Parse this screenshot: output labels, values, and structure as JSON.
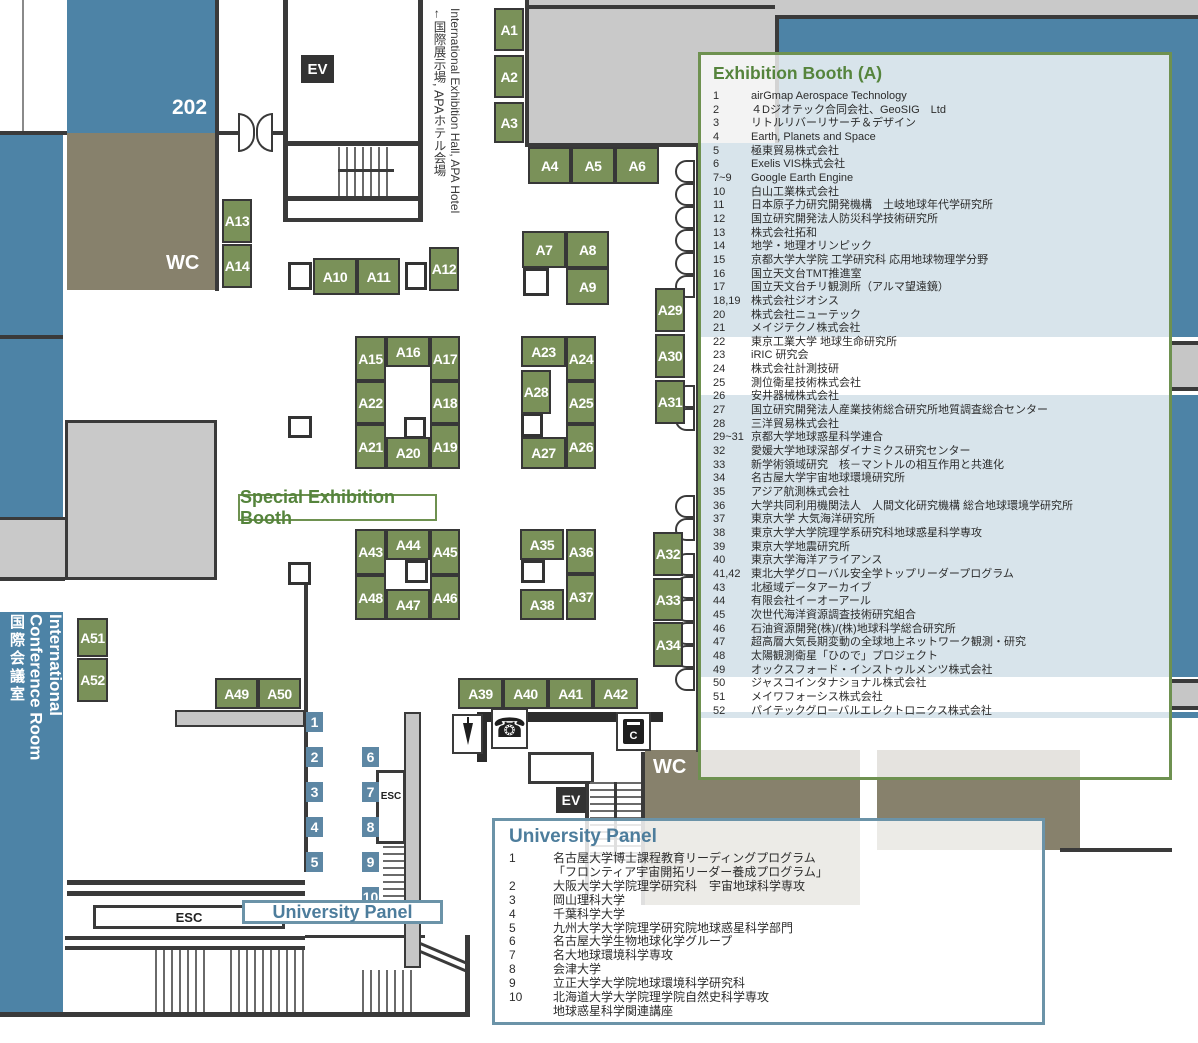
{
  "colors": {
    "map_blue": "#4d83a6",
    "num_blue": "#5d87a4",
    "olive": "#87816c",
    "hall_gray": "#c9c9c9",
    "booth_green": "#7a9159",
    "panel_green": "#6e9150",
    "panel_green_text": "#55843c",
    "uni_blue_border": "#6b93a8",
    "uni_blue_text": "#4d7d9c"
  },
  "map": {
    "rooms": {
      "room202": "202",
      "wc_top": "WC",
      "wc_bottom": "WC",
      "ev_top": "EV",
      "ev_bottom": "EV",
      "esc_mid": "ESC",
      "esc_bottom": "ESC"
    },
    "labels": {
      "special_booth": "Special Exhibition Booth",
      "university_tag": "University Panel",
      "conference_en": "International Conference Room",
      "conference_jp": "国際会議室",
      "exit_en": "International Exhibition Hall, APA Hotel",
      "exit_jp": "←国際展示場, APAホテル会場"
    },
    "icons": {
      "phone_glyph": "☎",
      "copier_label": "C"
    },
    "panel_numbers": {
      "col1": [
        "1",
        "2",
        "3",
        "4",
        "5"
      ],
      "col2": [
        "6",
        "7",
        "8",
        "9",
        "10"
      ]
    },
    "door_pairs_right": [
      160,
      206,
      252,
      385,
      495,
      553,
      599,
      645
    ],
    "squares": [
      [
        288,
        262,
        24,
        28
      ],
      [
        405,
        262,
        22,
        28
      ],
      [
        523,
        268,
        26,
        28
      ],
      [
        288,
        416,
        24,
        22
      ],
      [
        404,
        417,
        22,
        22
      ],
      [
        521,
        413,
        22,
        24
      ],
      [
        288,
        562,
        23,
        23
      ],
      [
        405,
        560,
        23,
        23
      ],
      [
        521,
        560,
        24,
        23
      ]
    ],
    "booths": [
      {
        "label": "A1",
        "x": 494,
        "y": 8,
        "w": 30,
        "h": 43
      },
      {
        "label": "A2",
        "x": 494,
        "y": 55,
        "w": 30,
        "h": 43
      },
      {
        "label": "A3",
        "x": 494,
        "y": 102,
        "w": 30,
        "h": 41
      },
      {
        "label": "A4",
        "x": 528,
        "y": 147,
        "w": 43,
        "h": 37
      },
      {
        "label": "A5",
        "x": 571,
        "y": 147,
        "w": 44,
        "h": 37
      },
      {
        "label": "A6",
        "x": 615,
        "y": 147,
        "w": 44,
        "h": 37
      },
      {
        "label": "A7",
        "x": 522,
        "y": 231,
        "w": 44,
        "h": 37
      },
      {
        "label": "A8",
        "x": 566,
        "y": 231,
        "w": 43,
        "h": 37
      },
      {
        "label": "A9",
        "x": 566,
        "y": 268,
        "w": 43,
        "h": 37
      },
      {
        "label": "A10",
        "x": 313,
        "y": 258,
        "w": 44,
        "h": 37
      },
      {
        "label": "A11",
        "x": 357,
        "y": 258,
        "w": 43,
        "h": 37
      },
      {
        "label": "A12",
        "x": 429,
        "y": 247,
        "w": 30,
        "h": 44
      },
      {
        "label": "A13",
        "x": 222,
        "y": 199,
        "w": 30,
        "h": 44
      },
      {
        "label": "A14",
        "x": 222,
        "y": 244,
        "w": 30,
        "h": 44
      },
      {
        "label": "A15",
        "x": 355,
        "y": 336,
        "w": 31,
        "h": 45
      },
      {
        "label": "A16",
        "x": 386,
        "y": 336,
        "w": 44,
        "h": 31
      },
      {
        "label": "A17",
        "x": 430,
        "y": 336,
        "w": 30,
        "h": 45
      },
      {
        "label": "A18",
        "x": 430,
        "y": 381,
        "w": 30,
        "h": 43
      },
      {
        "label": "A19",
        "x": 430,
        "y": 424,
        "w": 30,
        "h": 45
      },
      {
        "label": "A20",
        "x": 386,
        "y": 437,
        "w": 44,
        "h": 32
      },
      {
        "label": "A21",
        "x": 355,
        "y": 424,
        "w": 31,
        "h": 45
      },
      {
        "label": "A22",
        "x": 355,
        "y": 381,
        "w": 31,
        "h": 43
      },
      {
        "label": "A23",
        "x": 521,
        "y": 336,
        "w": 45,
        "h": 31
      },
      {
        "label": "A24",
        "x": 566,
        "y": 336,
        "w": 30,
        "h": 45
      },
      {
        "label": "A25",
        "x": 566,
        "y": 381,
        "w": 30,
        "h": 43
      },
      {
        "label": "A26",
        "x": 566,
        "y": 424,
        "w": 30,
        "h": 45
      },
      {
        "label": "A27",
        "x": 521,
        "y": 437,
        "w": 45,
        "h": 32
      },
      {
        "label": "A28",
        "x": 521,
        "y": 370,
        "w": 30,
        "h": 44
      },
      {
        "label": "A29",
        "x": 655,
        "y": 288,
        "w": 30,
        "h": 44
      },
      {
        "label": "A30",
        "x": 655,
        "y": 334,
        "w": 30,
        "h": 44
      },
      {
        "label": "A31",
        "x": 655,
        "y": 380,
        "w": 30,
        "h": 44
      },
      {
        "label": "A32",
        "x": 653,
        "y": 532,
        "w": 30,
        "h": 44
      },
      {
        "label": "A33",
        "x": 653,
        "y": 578,
        "w": 30,
        "h": 43
      },
      {
        "label": "A34",
        "x": 653,
        "y": 622,
        "w": 30,
        "h": 45
      },
      {
        "label": "A35",
        "x": 520,
        "y": 529,
        "w": 44,
        "h": 31
      },
      {
        "label": "A36",
        "x": 566,
        "y": 529,
        "w": 30,
        "h": 45
      },
      {
        "label": "A37",
        "x": 566,
        "y": 574,
        "w": 30,
        "h": 46
      },
      {
        "label": "A38",
        "x": 520,
        "y": 589,
        "w": 44,
        "h": 31
      },
      {
        "label": "A39",
        "x": 458,
        "y": 678,
        "w": 45,
        "h": 31
      },
      {
        "label": "A40",
        "x": 503,
        "y": 678,
        "w": 45,
        "h": 31
      },
      {
        "label": "A41",
        "x": 548,
        "y": 678,
        "w": 45,
        "h": 31
      },
      {
        "label": "A42",
        "x": 593,
        "y": 678,
        "w": 45,
        "h": 31
      },
      {
        "label": "A43",
        "x": 355,
        "y": 529,
        "w": 31,
        "h": 46
      },
      {
        "label": "A44",
        "x": 386,
        "y": 529,
        "w": 44,
        "h": 31
      },
      {
        "label": "A45",
        "x": 430,
        "y": 529,
        "w": 30,
        "h": 46
      },
      {
        "label": "A46",
        "x": 430,
        "y": 575,
        "w": 30,
        "h": 45
      },
      {
        "label": "A47",
        "x": 386,
        "y": 589,
        "w": 44,
        "h": 31
      },
      {
        "label": "A48",
        "x": 355,
        "y": 575,
        "w": 31,
        "h": 45
      },
      {
        "label": "A49",
        "x": 215,
        "y": 678,
        "w": 43,
        "h": 31
      },
      {
        "label": "A50",
        "x": 258,
        "y": 678,
        "w": 43,
        "h": 31
      },
      {
        "label": "A51",
        "x": 77,
        "y": 618,
        "w": 31,
        "h": 39
      },
      {
        "label": "A52",
        "x": 77,
        "y": 658,
        "w": 31,
        "h": 44
      }
    ]
  },
  "exhibition_panel": {
    "title": "Exhibition Booth (A)",
    "entries": [
      {
        "no": "1",
        "name": "airGmap Aerospace Technology"
      },
      {
        "no": "2",
        "name": "４Dジオテック合同会社、GeoSIG　Ltd"
      },
      {
        "no": "3",
        "name": "リトルリバーリサーチ＆デザイン"
      },
      {
        "no": "4",
        "name": "Earth, Planets and Space"
      },
      {
        "no": "5",
        "name": "極東貿易株式会社"
      },
      {
        "no": "6",
        "name": "Exelis VIS株式会社"
      },
      {
        "no": "7~9",
        "name": "Google Earth Engine"
      },
      {
        "no": "10",
        "name": "白山工業株式会社"
      },
      {
        "no": "11",
        "name": "日本原子力研究開発機構　土岐地球年代学研究所"
      },
      {
        "no": "12",
        "name": "国立研究開発法人防災科学技術研究所"
      },
      {
        "no": "13",
        "name": "株式会社拓和"
      },
      {
        "no": "14",
        "name": "地学・地理オリンピック"
      },
      {
        "no": "15",
        "name": "京都大学大学院 工学研究科 応用地球物理学分野"
      },
      {
        "no": "16",
        "name": "国立天文台TMT推進室"
      },
      {
        "no": "17",
        "name": "国立天文台チリ観測所（アルマ望遠鏡）"
      },
      {
        "no": "18,19",
        "name": "株式会社ジオシス"
      },
      {
        "no": "20",
        "name": "株式会社ニューテック"
      },
      {
        "no": "21",
        "name": "メイジテクノ株式会社"
      },
      {
        "no": "22",
        "name": "東京工業大学 地球生命研究所"
      },
      {
        "no": "23",
        "name": "iRIC 研究会"
      },
      {
        "no": "24",
        "name": "株式会社計測技研"
      },
      {
        "no": "25",
        "name": "測位衛星技術株式会社"
      },
      {
        "no": "26",
        "name": "安井器械株式会社"
      },
      {
        "no": "27",
        "name": "国立研究開発法人産業技術総合研究所地質調査総合センター"
      },
      {
        "no": "28",
        "name": "三洋貿易株式会社"
      },
      {
        "no": "29~31",
        "name": "京都大学地球惑星科学連合"
      },
      {
        "no": "32",
        "name": "愛媛大学地球深部ダイナミクス研究センター"
      },
      {
        "no": "33",
        "name": "新学術領域研究　核－マントルの相互作用と共進化"
      },
      {
        "no": "34",
        "name": "名古屋大学宇宙地球環境研究所"
      },
      {
        "no": "35",
        "name": "アジア航測株式会社"
      },
      {
        "no": "36",
        "name": "大学共同利用機関法人　人間文化研究機構 総合地球環境学研究所"
      },
      {
        "no": "37",
        "name": "東京大学 大気海洋研究所"
      },
      {
        "no": "38",
        "name": "東京大学大学院理学系研究科地球惑星科学専攻"
      },
      {
        "no": "39",
        "name": "東京大学地震研究所"
      },
      {
        "no": "40",
        "name": "東京大学海洋アライアンス"
      },
      {
        "no": "41,42",
        "name": "東北大学グローバル安全学トップリーダープログラム"
      },
      {
        "no": "43",
        "name": "北極域データアーカイブ"
      },
      {
        "no": "44",
        "name": "有限会社イーオーアール"
      },
      {
        "no": "45",
        "name": "次世代海洋資源調査技術研究組合"
      },
      {
        "no": "46",
        "name": "石油資源開発(株)/(株)地球科学総合研究所"
      },
      {
        "no": "47",
        "name": "超高層大気長期変動の全球地上ネットワーク観測・研究"
      },
      {
        "no": "48",
        "name": "太陽観測衛星「ひので」プロジェクト"
      },
      {
        "no": "49",
        "name": "オックスフォード・インストゥルメンツ株式会社"
      },
      {
        "no": "50",
        "name": "ジャスコインタナショナル株式会社"
      },
      {
        "no": "51",
        "name": "メイワフォーシス株式会社"
      },
      {
        "no": "52",
        "name": "パイテックグローバルエレクトロニクス株式会社"
      }
    ]
  },
  "university_panel": {
    "title": "University Panel",
    "entries": [
      {
        "no": "1",
        "name": "名古屋大学博士課程教育リーディングプログラム"
      },
      {
        "no": "",
        "name": "「フロンティア宇宙開拓リーダー養成プログラム」"
      },
      {
        "no": "2",
        "name": "大阪大学大学院理学研究科　宇宙地球科学専攻"
      },
      {
        "no": "3",
        "name": "岡山理科大学"
      },
      {
        "no": "4",
        "name": "千葉科学大学"
      },
      {
        "no": "5",
        "name": "九州大学大学院理学研究院地球惑星科学部門"
      },
      {
        "no": "6",
        "name": "名古屋大学生物地球化学グループ"
      },
      {
        "no": "7",
        "name": "名大地球環境科学専攻"
      },
      {
        "no": "8",
        "name": "会津大学"
      },
      {
        "no": "9",
        "name": "立正大学大学院地球環境科学研究科"
      },
      {
        "no": "10",
        "name": "北海道大学大学院理学院自然史科学専攻"
      },
      {
        "no": "",
        "name": "地球惑星科学関連講座"
      }
    ]
  }
}
